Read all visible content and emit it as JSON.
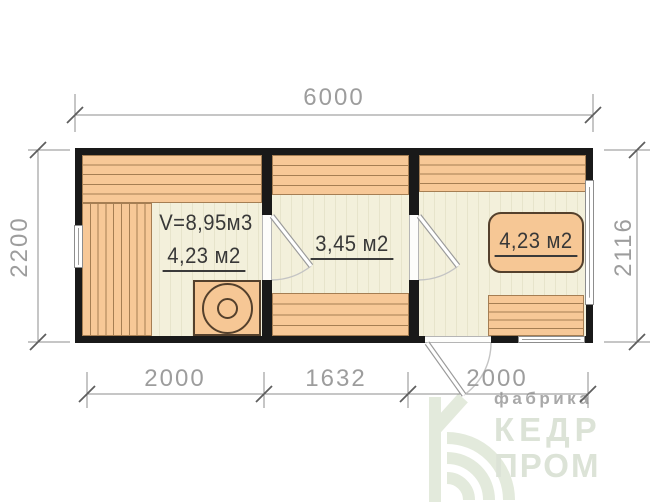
{
  "drawing": {
    "title_hint": "cabin floor plan 6000x2200",
    "dimensions": {
      "overall_width": "6000",
      "left_height": "2200",
      "right_height": "2116",
      "bottom_segments": [
        "2000",
        "1632",
        "2000"
      ]
    },
    "rooms": {
      "sauna": {
        "volume": "V=8,95м3",
        "area": "4,23 м2"
      },
      "washroom": {
        "area": "3,45 м2"
      },
      "lounge": {
        "area": "4,23 м2"
      }
    }
  },
  "logo": {
    "tagline": "фабрика",
    "name_line1": "КЕДР",
    "name_line2": "ПРОМ"
  },
  "colors": {
    "wood_fill": "#f7c897",
    "wood_line": "#a57e53",
    "wall": "#191919",
    "floor": "#f3f0db",
    "dim_text": "#9d9d9d",
    "logo_green": "#dce3d7",
    "logo_gray": "#a8a8a8"
  }
}
